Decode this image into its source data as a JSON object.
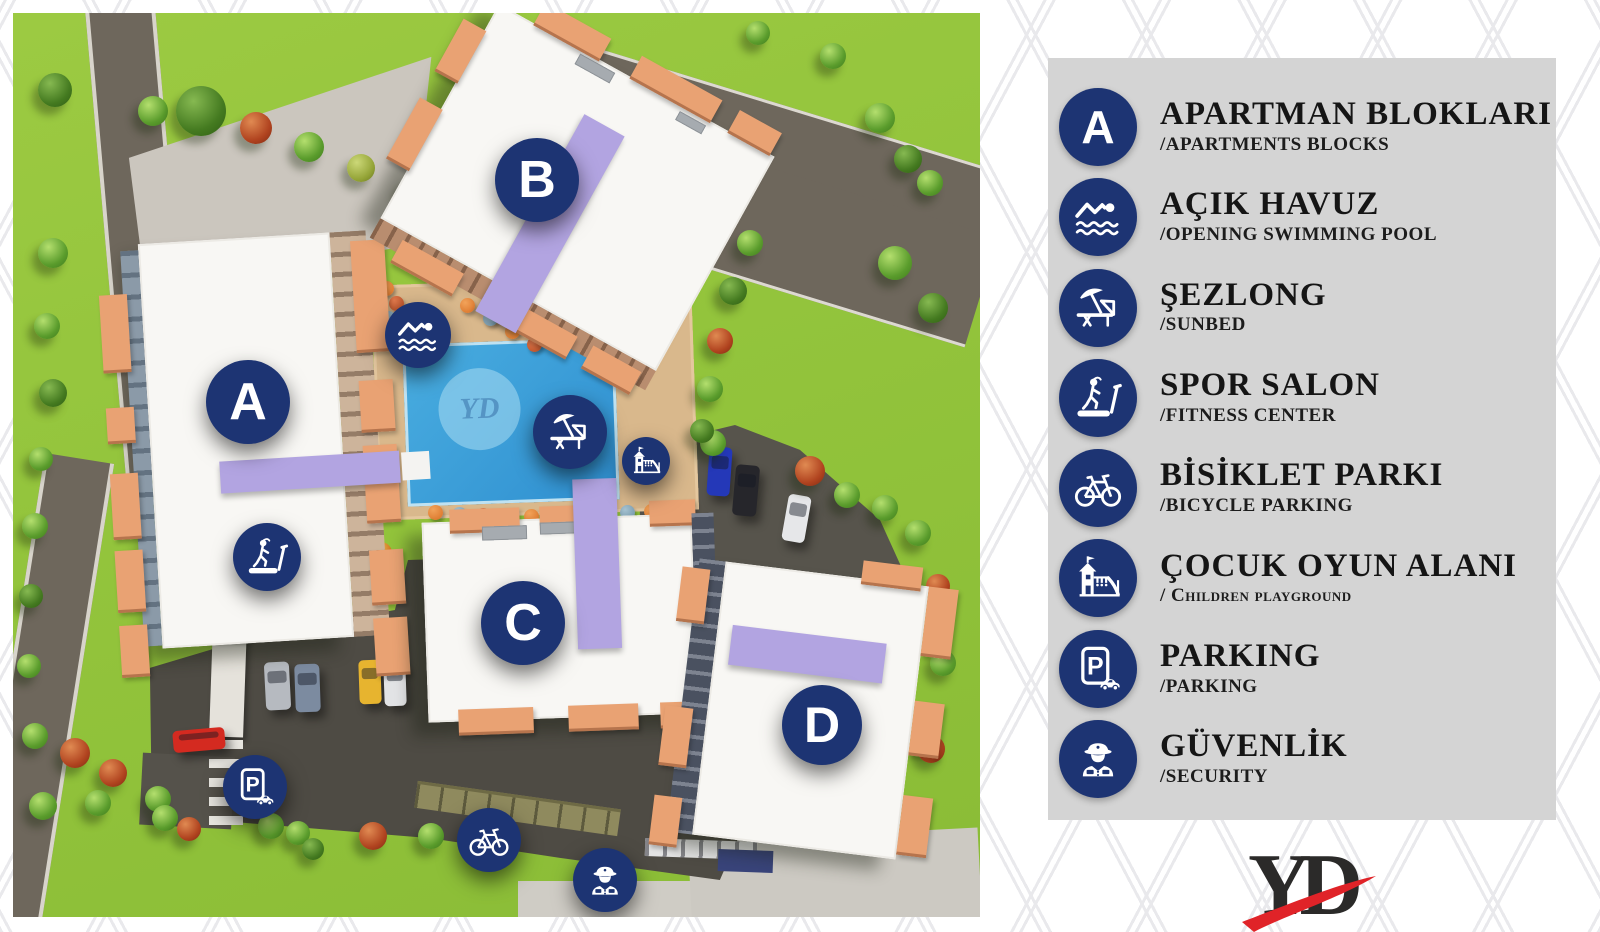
{
  "colors": {
    "badge_navy": "#1d3473",
    "legend_panel_gray": "#d4d4d4",
    "grass_green": "#93c43c",
    "road_gray": "#6e675c",
    "asphalt_dark": "#4e4b44",
    "pool_blue": "#3ba2da",
    "pool_deck_sand": "#d9b88c",
    "building_white": "#f8f7f4",
    "terracotta": "#e9a273",
    "roof_purple": "#b2a4e1",
    "logo_dark": "#2b2a29",
    "logo_red": "#e02328"
  },
  "map": {
    "buildings": [
      {
        "label": "A"
      },
      {
        "label": "B"
      },
      {
        "label": "C"
      },
      {
        "label": "D"
      }
    ],
    "markers": [
      "swimming-pool",
      "sunbed",
      "playground",
      "fitness",
      "parking",
      "bicycle",
      "security"
    ],
    "pool_watermark": "YD"
  },
  "legend": {
    "items": [
      {
        "icon": "block-letter",
        "letter": "A",
        "title": "APARTMAN BLOKLARI",
        "subtitle": "/APARTMENTS BLOCKS"
      },
      {
        "icon": "swimmer",
        "title": "AÇIK HAVUZ",
        "subtitle": "/OPENING SWIMMING POOL"
      },
      {
        "icon": "sunbed",
        "title": "ŞEZLONG",
        "subtitle": "/SUNBED"
      },
      {
        "icon": "treadmill",
        "title": "SPOR SALON",
        "subtitle": "/FITNESS CENTER"
      },
      {
        "icon": "bicycle",
        "title": "BİSİKLET PARKI",
        "subtitle": "/BICYCLE PARKING"
      },
      {
        "icon": "playground",
        "title": "ÇOCUK OYUN ALANI",
        "subtitle": "/ Children playground"
      },
      {
        "icon": "parking",
        "title": "PARKING",
        "subtitle": "/PARKING"
      },
      {
        "icon": "security",
        "title": "GÜVENLİK",
        "subtitle": "/SECURITY"
      }
    ]
  },
  "logo": {
    "text": "YD"
  }
}
